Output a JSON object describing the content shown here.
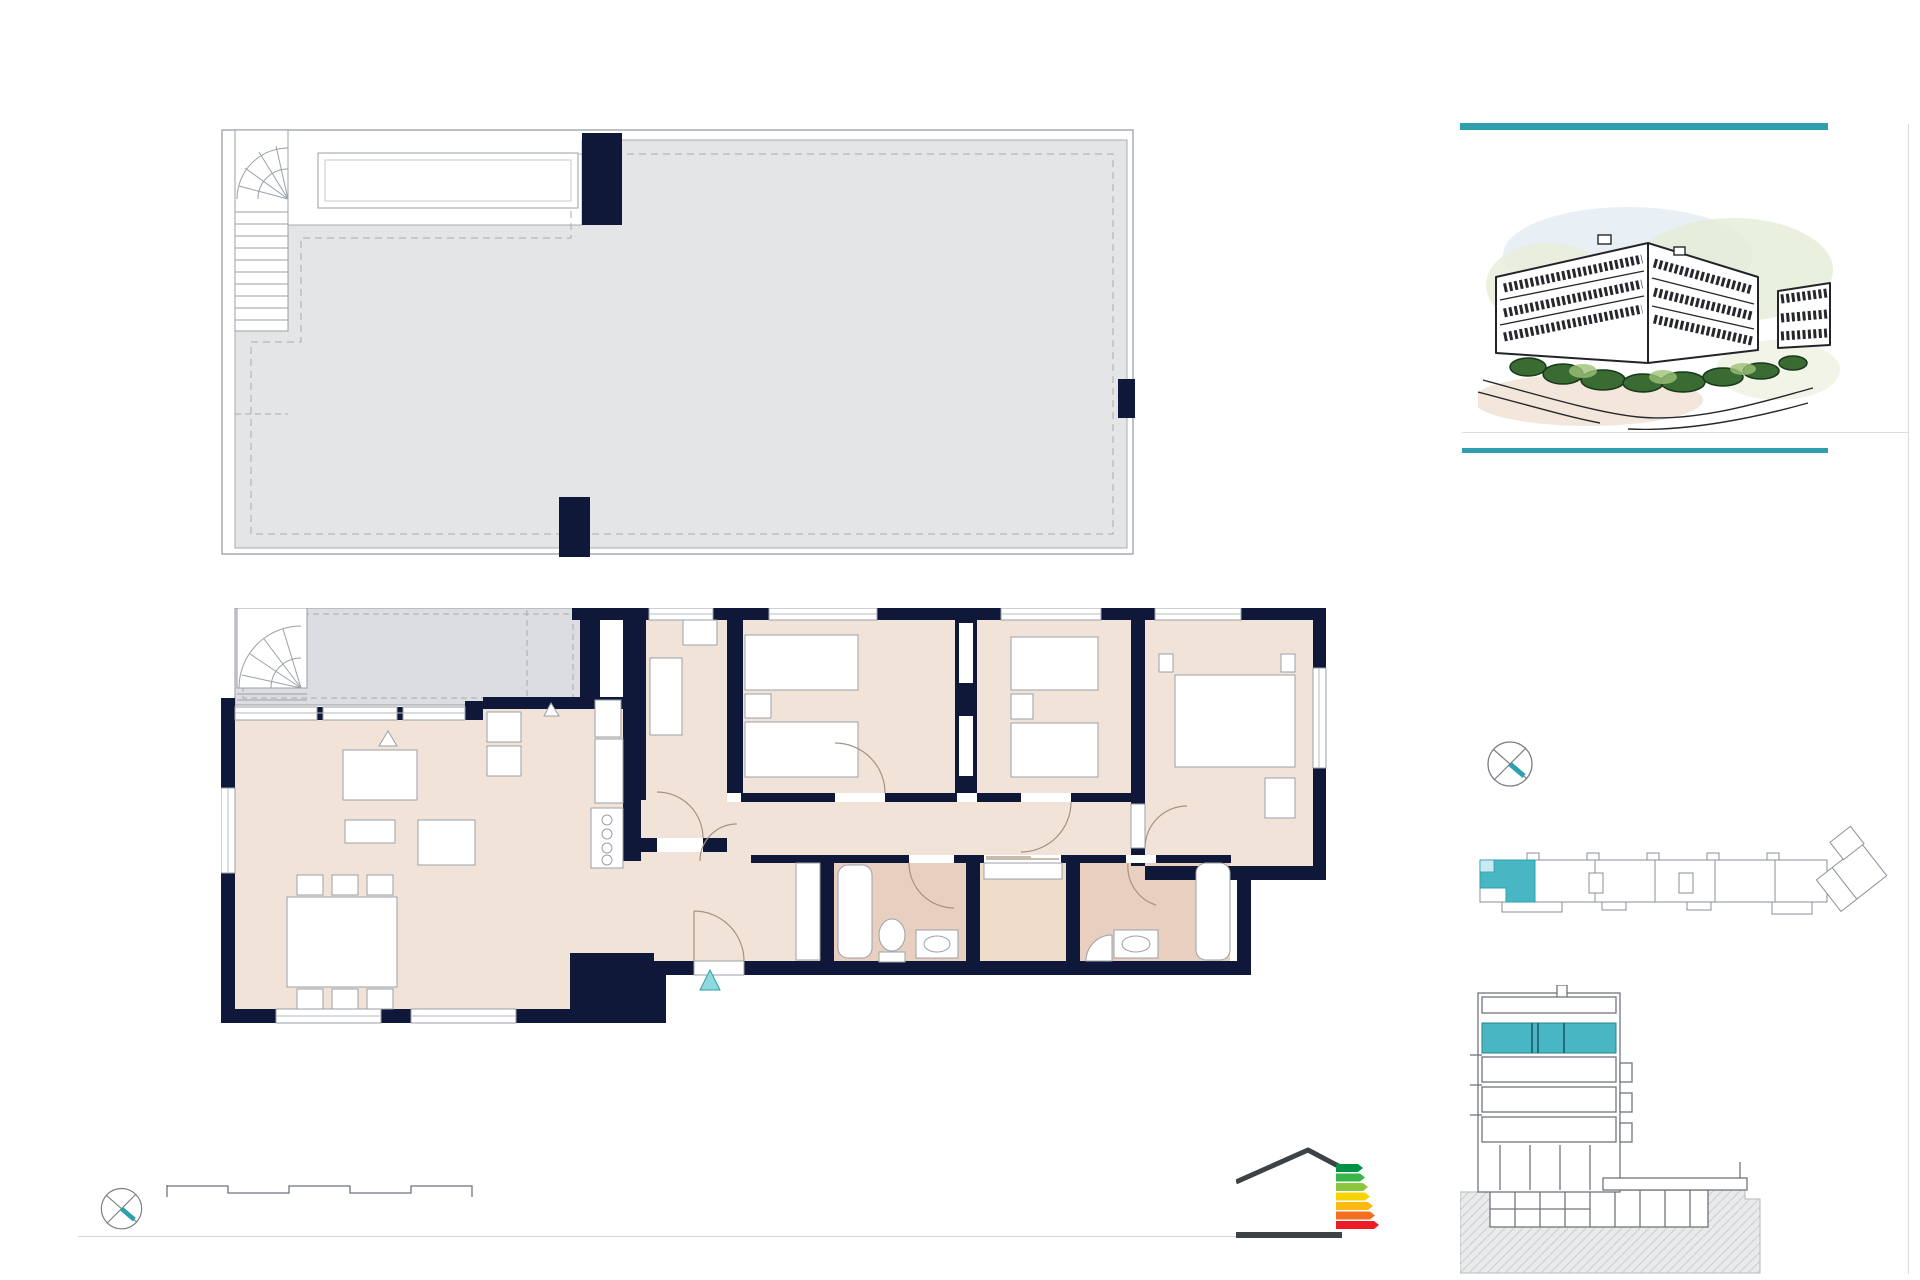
{
  "header": {
    "title": "Portal 1. P04 - C"
  },
  "superficies": {
    "title": "Superficies:",
    "unit_label": "Vivienda",
    "unit_code": "4d",
    "rows": [
      {
        "label": "Superficie útil interior",
        "value": "86,42m²"
      },
      {
        "label": "Superficie útil terrazas",
        "value": "88,75m²"
      },
      {
        "label": "Superficie construida interior",
        "value": "101,55m²"
      },
      {
        "label": "Superficie construida incluidas ZZCC",
        "value": "114,03m²"
      }
    ]
  },
  "roof_plan": {
    "room": {
      "name": "CUBIERTA PRIVADA",
      "area": "80.07 m²"
    }
  },
  "floor_plan": {
    "rooms": [
      {
        "name": "TERRAZA DESCUBIERTA",
        "area": "7.51 m²"
      },
      {
        "name": "TENDEDERO",
        "area": "1.17 m²"
      },
      {
        "name": "COCINA",
        "area": "5.27 m²"
      },
      {
        "name": "DORMITORIO 4",
        "area": "7.46 m²"
      },
      {
        "name": "DORMITORIO 3",
        "area": "9.00 m²"
      },
      {
        "name": "DORMITORIO 2",
        "area": "8.79 m²"
      },
      {
        "name": "DORMITORIO 1",
        "area": "11.68 m²"
      },
      {
        "name": "SALÓN-COMEDOR",
        "area": "24.95 m²"
      },
      {
        "name": "DISTRIBUIDOR",
        "area": "4.88 m²"
      },
      {
        "name": "VESTÍBULO",
        "area": "4.09 m²"
      },
      {
        "name": "BAÑO 2",
        "area": "3.86 m²"
      },
      {
        "name": "CLOSET",
        "area": "2.68 m²"
      },
      {
        "name": "BAÑO 1",
        "area": "3.76 m²"
      }
    ],
    "appliances": {
      "a1": "H+M",
      "a2": "NV",
      "a3": "LVV",
      "a4": "LV"
    },
    "entrance_label": "C"
  },
  "scale_bar": {
    "title": "ESCALA GRÁFICA",
    "tick0": "0",
    "tick1": "1",
    "tick2": "5 m"
  },
  "compass": {
    "north_label": "N"
  },
  "disclaimer": {
    "line1": "El presente plano comercial, que incluye una parte gráfica y datos relativos a las superficies, puede ser objeto de modificaciones ordenadas por los organismos públicos competentes y/o exigencias técnicas o jurídicas,",
    "line2": "siempre y cuando estén justificados y no supongan alteraciones sustanciales. El mobiliario mostrado no está incluido y el equipamiento del inmueble será el indicado en la correspondiente memoria de calidades"
  },
  "energy_logo": {
    "energy_letter": "B",
    "emissions_letter": "A",
    "energy_label": "Energía",
    "emissions_label": "Emisiones",
    "status": "PROVISIONAL",
    "scale_letters": [
      "A",
      "B",
      "C",
      "D",
      "E",
      "F",
      "G"
    ]
  },
  "drawing_code": "V02",
  "colors": {
    "teal": "#2D9FAE",
    "highlight_teal": "#49B7C3",
    "orange": "#E9A43C",
    "navy": "#101839"
  }
}
